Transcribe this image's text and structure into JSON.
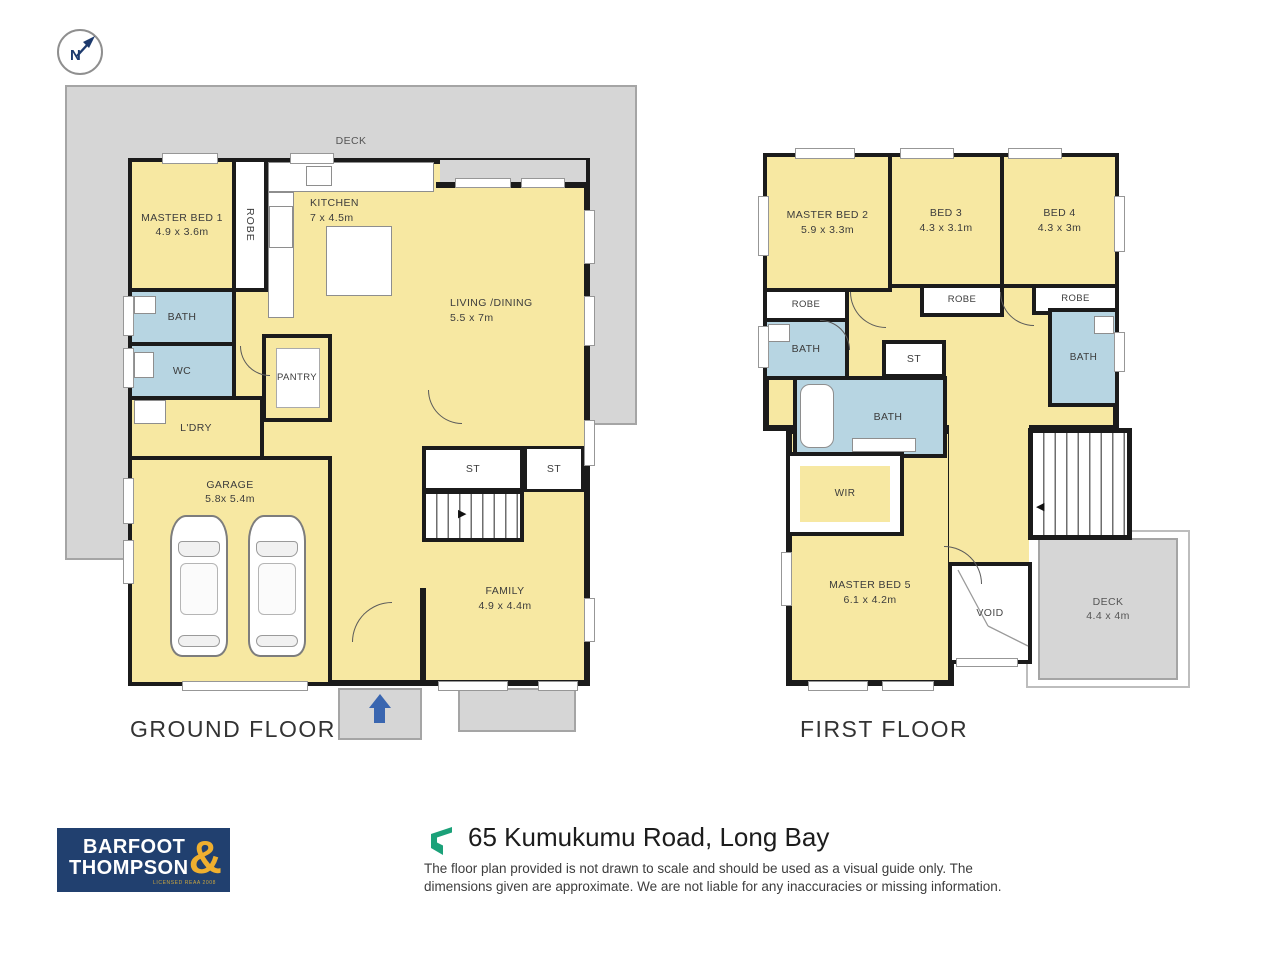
{
  "compass": {
    "label": "N"
  },
  "ground_floor": {
    "title": "GROUND FLOOR",
    "deck_label": "DECK",
    "rooms": {
      "master_bed_1": {
        "name": "MASTER BED 1",
        "dims": "4.9 x 3.6m"
      },
      "robe": {
        "name": "ROBE"
      },
      "kitchen": {
        "name": "KITCHEN",
        "dims": "7 x 4.5m"
      },
      "living_dining": {
        "name": "LIVING /DINING",
        "dims": "5.5 x 7m"
      },
      "bath": {
        "name": "BATH"
      },
      "wc": {
        "name": "WC"
      },
      "ldry": {
        "name": "L'DRY"
      },
      "pantry": {
        "name": "PANTRY"
      },
      "garage": {
        "name": "GARAGE",
        "dims": "5.8x 5.4m"
      },
      "st_left": {
        "name": "ST"
      },
      "st_right": {
        "name": "ST"
      },
      "family": {
        "name": "FAMILY",
        "dims": "4.9 x 4.4m"
      }
    }
  },
  "first_floor": {
    "title": "FIRST FLOOR",
    "rooms": {
      "master_bed_2": {
        "name": "MASTER BED 2",
        "dims": "5.9 x 3.3m"
      },
      "bed_3": {
        "name": "BED 3",
        "dims": "4.3 x 3.1m"
      },
      "bed_4": {
        "name": "BED 4",
        "dims": "4.3 x 3m"
      },
      "robe_1": {
        "name": "ROBE"
      },
      "robe_2": {
        "name": "ROBE"
      },
      "robe_3": {
        "name": "ROBE"
      },
      "bath_left": {
        "name": "BATH"
      },
      "bath_center": {
        "name": "BATH"
      },
      "bath_right": {
        "name": "BATH"
      },
      "st": {
        "name": "ST"
      },
      "wir": {
        "name": "WIR"
      },
      "master_bed_5": {
        "name": "MASTER BED 5",
        "dims": "6.1 x 4.2m"
      },
      "void": {
        "name": "VOID"
      },
      "deck": {
        "name": "DECK",
        "dims": "4.4 x 4m"
      }
    }
  },
  "footer": {
    "logo": {
      "line1": "BARFOOT",
      "line2": "THOMPSON",
      "ampersand": "&",
      "tagline": "LICENSED REAA 2008"
    },
    "address": "65 Kumukumu Road, Long Bay",
    "disclaimer_line1": "The floor plan provided is not drawn to scale and should be used as a visual guide only. The",
    "disclaimer_line2": "dimensions given are approximate. We are not liable for any inaccuracies or missing information."
  },
  "colors": {
    "room_fill": "#F7E8A2",
    "wet_area_fill": "#B7D5E2",
    "deck_fill": "#D6D6D6",
    "wall": "#1B1B1B",
    "logo_navy": "#21406F",
    "logo_gold": "#EFAF2F",
    "brand_green": "#1BA179",
    "entry_arrow_blue": "#3A66B0"
  }
}
